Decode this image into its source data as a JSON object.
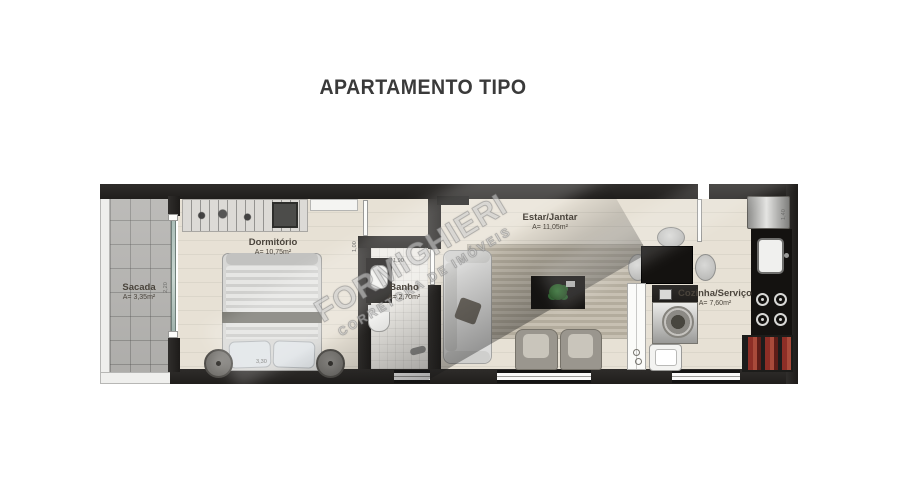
{
  "title": "APARTAMENTO TIPO",
  "watermark": {
    "line1": "FORMIGHIERI",
    "line2": "CORRETORA DE IMÓVEIS"
  },
  "rooms": {
    "sacada": {
      "name": "Sacada",
      "area": "A= 3,35m²"
    },
    "dormitorio": {
      "name": "Dormitório",
      "area": "A= 10,75m²"
    },
    "banho": {
      "name": "Banho",
      "area": "A= 2,70m²"
    },
    "estar": {
      "name": "Estar/Jantar",
      "area": "A= 11,05m²"
    },
    "cozinha": {
      "name": "Cozinha/Serviço",
      "area": "A= 7,60m²"
    }
  },
  "dimensions": {
    "sacada_door": "2,20",
    "banho_width": "1,00",
    "banho_counter": "1,90",
    "dormitorio_width": "3,30",
    "cozinha_depth": "1,40"
  },
  "colors": {
    "wall": "#262422",
    "floor": "#e7e1d5",
    "accent_red": "#8d2e26",
    "plant_green": "#2f7d33"
  }
}
